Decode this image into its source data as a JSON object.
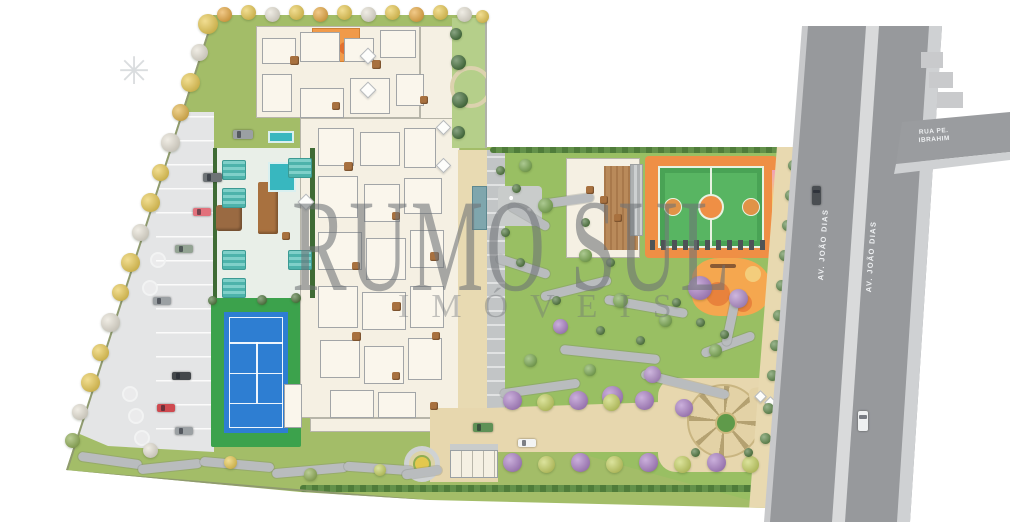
{
  "watermark": {
    "line1": "RUMO SUL",
    "line2": "IMÓVEIS",
    "color": "#6e7276"
  },
  "streets": {
    "avenue_left_label": "AV. JOÃO DIAS",
    "avenue_right_label": "AV. JOÃO DIAS",
    "side_street_label": "RUA PE. IBRAHIM"
  },
  "colors": {
    "lawn": "#a3bd68",
    "garden": "#99bf63",
    "asphalt": "#97999c",
    "median": "#d9dadb",
    "sidewalk": "#cfd1d3",
    "parking": "#e4e5e6",
    "building": "#f5f0e3",
    "tennis_blue": "#2e7ed2",
    "tennis_green": "#3ca24c",
    "court_orange": "#ef8f45",
    "court_green": "#58b562",
    "play_orange": "#f5a74f",
    "pool_teal": "#38b7bf",
    "drive_beige": "#e7d7ae",
    "purple_tree": "#ab7fc6",
    "yellow_tree": "#e9c94f"
  },
  "scene": {
    "trees": [
      [
        208,
        24,
        20,
        "#e9c94f"
      ],
      [
        199,
        52,
        17,
        "#e6e1d4"
      ],
      [
        190,
        82,
        19,
        "#e9c94f"
      ],
      [
        180,
        112,
        17,
        "#e3b448"
      ],
      [
        170,
        142,
        19,
        "#e6e1d4"
      ],
      [
        160,
        172,
        17,
        "#e9c94f"
      ],
      [
        150,
        202,
        19,
        "#e9c94f"
      ],
      [
        140,
        232,
        17,
        "#e6e1d4"
      ],
      [
        130,
        262,
        19,
        "#e9c94f"
      ],
      [
        120,
        292,
        17,
        "#e9c94f"
      ],
      [
        110,
        322,
        19,
        "#e6e1d4"
      ],
      [
        100,
        352,
        17,
        "#e9c94f"
      ],
      [
        90,
        382,
        19,
        "#e9c94f"
      ],
      [
        80,
        412,
        16,
        "#e6e1d4"
      ],
      [
        72,
        440,
        15,
        "#8fae53"
      ],
      [
        224,
        14,
        15,
        "#e8a83f"
      ],
      [
        248,
        12,
        15,
        "#e9c94f"
      ],
      [
        272,
        14,
        15,
        "#e6e1d4"
      ],
      [
        296,
        12,
        15,
        "#e9c94f"
      ],
      [
        320,
        14,
        15,
        "#e8a83f"
      ],
      [
        344,
        12,
        15,
        "#e9c94f"
      ],
      [
        368,
        14,
        15,
        "#e6e1d4"
      ],
      [
        392,
        12,
        15,
        "#e9c94f"
      ],
      [
        416,
        14,
        15,
        "#e8a83f"
      ],
      [
        440,
        12,
        15,
        "#e9c94f"
      ],
      [
        464,
        14,
        15,
        "#e6e1d4"
      ],
      [
        482,
        16,
        13,
        "#e9c94f"
      ],
      [
        700,
        288,
        24,
        "#ab7fc6"
      ],
      [
        738,
        298,
        19,
        "#b08ac9"
      ],
      [
        612,
        396,
        21,
        "#ab7fc6"
      ],
      [
        652,
        374,
        17,
        "#b08ac9"
      ],
      [
        560,
        326,
        15,
        "#ab7fc6"
      ],
      [
        684,
        408,
        18,
        "#ab7fc6"
      ],
      [
        525,
        165,
        13,
        "#79a84e"
      ],
      [
        545,
        205,
        15,
        "#79a84e"
      ],
      [
        585,
        255,
        13,
        "#79a84e"
      ],
      [
        620,
        300,
        15,
        "#79a84e"
      ],
      [
        665,
        320,
        13,
        "#79a84e"
      ],
      [
        715,
        350,
        13,
        "#79a84e"
      ],
      [
        590,
        370,
        12,
        "#79a84e"
      ],
      [
        530,
        360,
        13,
        "#79a84e"
      ],
      [
        512,
        400,
        19,
        "#ab7fc6"
      ],
      [
        545,
        402,
        17,
        "#c6d260"
      ],
      [
        578,
        400,
        19,
        "#ab7fc6"
      ],
      [
        611,
        402,
        17,
        "#c6d260"
      ],
      [
        644,
        400,
        19,
        "#ab7fc6"
      ],
      [
        788,
        390,
        15,
        "#ab7fc6"
      ],
      [
        512,
        462,
        19,
        "#ab7fc6"
      ],
      [
        546,
        464,
        17,
        "#c6d260"
      ],
      [
        580,
        462,
        19,
        "#ab7fc6"
      ],
      [
        614,
        464,
        17,
        "#c6d260"
      ],
      [
        648,
        462,
        19,
        "#ab7fc6"
      ],
      [
        682,
        464,
        17,
        "#c6d260"
      ],
      [
        716,
        462,
        19,
        "#ab7fc6"
      ],
      [
        750,
        464,
        17,
        "#c6d260"
      ],
      [
        782,
        458,
        16,
        "#ab7fc6"
      ],
      [
        793,
        165,
        11,
        "#5c8747"
      ],
      [
        790,
        195,
        11,
        "#5c8747"
      ],
      [
        787,
        225,
        11,
        "#5c8747"
      ],
      [
        784,
        255,
        11,
        "#5c8747"
      ],
      [
        781,
        285,
        11,
        "#5c8747"
      ],
      [
        778,
        315,
        11,
        "#5c8747"
      ],
      [
        775,
        345,
        11,
        "#5c8747"
      ],
      [
        772,
        375,
        11,
        "#5c8747"
      ],
      [
        768,
        408,
        11,
        "#5c8747"
      ],
      [
        765,
        438,
        11,
        "#5c8747"
      ],
      [
        150,
        450,
        15,
        "#e6e1d4"
      ],
      [
        230,
        462,
        13,
        "#e9c94f"
      ],
      [
        310,
        474,
        13,
        "#8fae53"
      ],
      [
        380,
        470,
        12,
        "#c6d260"
      ],
      [
        500,
        170,
        9,
        "#4a7338"
      ],
      [
        516,
        188,
        9,
        "#4a7338"
      ],
      [
        505,
        232,
        9,
        "#4a7338"
      ],
      [
        520,
        262,
        9,
        "#4a7338"
      ],
      [
        556,
        300,
        9,
        "#4a7338"
      ],
      [
        600,
        330,
        9,
        "#4a7338"
      ],
      [
        640,
        340,
        9,
        "#4a7338"
      ],
      [
        676,
        302,
        9,
        "#4a7338"
      ],
      [
        700,
        322,
        9,
        "#4a7338"
      ],
      [
        724,
        334,
        9,
        "#4a7338"
      ],
      [
        610,
        262,
        9,
        "#4a7338"
      ],
      [
        585,
        222,
        9,
        "#4a7338"
      ],
      [
        695,
        452,
        9,
        "#4a7338"
      ],
      [
        748,
        452,
        9,
        "#4a7338"
      ],
      [
        456,
        34,
        12,
        "#3f6b35"
      ],
      [
        458,
        62,
        15,
        "#3f6b35"
      ],
      [
        460,
        100,
        16,
        "#3f6b35"
      ],
      [
        458,
        132,
        13,
        "#3f6b35"
      ],
      [
        262,
        300,
        10,
        "#4a7338"
      ],
      [
        296,
        298,
        10,
        "#4a7338"
      ],
      [
        212,
        300,
        9,
        "#4a7338"
      ]
    ],
    "cars": [
      [
        233,
        130,
        20,
        9,
        "#9ba0a3"
      ],
      [
        203,
        173,
        19,
        9,
        "#6e7376"
      ],
      [
        193,
        208,
        18,
        8,
        "#e2717c"
      ],
      [
        175,
        245,
        18,
        8,
        "#93a393"
      ],
      [
        153,
        297,
        18,
        8,
        "#9ba0a3"
      ],
      [
        172,
        372,
        19,
        8,
        "#43474a"
      ],
      [
        157,
        404,
        18,
        8,
        "#cf4a50"
      ],
      [
        175,
        427,
        18,
        8,
        "#9ba0a3"
      ],
      [
        473,
        423,
        20,
        9,
        "#5f9156"
      ],
      [
        518,
        439,
        18,
        8,
        "#f3f4f4"
      ]
    ],
    "road_cars": [
      [
        812,
        186,
        9,
        19,
        "#4a4e52"
      ],
      [
        858,
        411,
        10,
        20,
        "#eef0f1"
      ]
    ],
    "rooms": [
      [
        262,
        38,
        34,
        26
      ],
      [
        300,
        32,
        40,
        30
      ],
      [
        344,
        38,
        30,
        24
      ],
      [
        380,
        30,
        36,
        28
      ],
      [
        262,
        74,
        30,
        38
      ],
      [
        300,
        88,
        44,
        30
      ],
      [
        350,
        78,
        40,
        36
      ],
      [
        396,
        74,
        28,
        32
      ],
      [
        318,
        128,
        36,
        38
      ],
      [
        360,
        132,
        40,
        34
      ],
      [
        404,
        128,
        32,
        40
      ],
      [
        318,
        176,
        40,
        42
      ],
      [
        364,
        184,
        36,
        38
      ],
      [
        404,
        178,
        38,
        36
      ],
      [
        318,
        232,
        44,
        38
      ],
      [
        366,
        238,
        40,
        42
      ],
      [
        410,
        230,
        34,
        38
      ],
      [
        318,
        286,
        40,
        42
      ],
      [
        362,
        292,
        44,
        38
      ],
      [
        410,
        286,
        34,
        42
      ],
      [
        320,
        340,
        40,
        38
      ],
      [
        364,
        346,
        40,
        38
      ],
      [
        408,
        338,
        34,
        42
      ],
      [
        330,
        390,
        44,
        28
      ],
      [
        378,
        392,
        38,
        26
      ],
      [
        284,
        384,
        18,
        44
      ]
    ],
    "furniture": [
      [
        290,
        56,
        9
      ],
      [
        332,
        102,
        8
      ],
      [
        372,
        60,
        9
      ],
      [
        420,
        96,
        8
      ],
      [
        344,
        162,
        9
      ],
      [
        392,
        212,
        8
      ],
      [
        430,
        252,
        9
      ],
      [
        352,
        262,
        8
      ],
      [
        392,
        302,
        9
      ],
      [
        432,
        332,
        8
      ],
      [
        352,
        332,
        9
      ],
      [
        392,
        372,
        8
      ],
      [
        430,
        402,
        8
      ],
      [
        282,
        232,
        8
      ],
      [
        600,
        196,
        8
      ],
      [
        614,
        214,
        8
      ],
      [
        586,
        186,
        8
      ]
    ],
    "paths": [
      [
        78,
        456,
        64,
        9,
        8
      ],
      [
        138,
        462,
        64,
        9,
        -6
      ],
      [
        200,
        460,
        74,
        9,
        5
      ],
      [
        272,
        466,
        76,
        9,
        -5
      ],
      [
        344,
        464,
        70,
        9,
        4
      ],
      [
        402,
        468,
        40,
        9,
        -8
      ],
      [
        495,
        262,
        56,
        9,
        18
      ],
      [
        540,
        284,
        72,
        9,
        -14
      ],
      [
        604,
        302,
        84,
        9,
        10
      ],
      [
        560,
        350,
        100,
        9,
        6
      ],
      [
        500,
        384,
        80,
        9,
        -8
      ],
      [
        640,
        380,
        90,
        9,
        14
      ],
      [
        700,
        340,
        56,
        9,
        -20
      ],
      [
        506,
        212,
        46,
        9,
        30
      ],
      [
        544,
        196,
        50,
        9,
        -8
      ],
      [
        726,
        300,
        9,
        46,
        12
      ]
    ],
    "loungers": [
      [
        222,
        160
      ],
      [
        222,
        188
      ],
      [
        222,
        250
      ],
      [
        222,
        278
      ],
      [
        288,
        158
      ],
      [
        288,
        250
      ]
    ],
    "planters": [
      [
        122,
        386,
        16
      ],
      [
        128,
        408,
        16
      ],
      [
        134,
        430,
        16
      ],
      [
        150,
        252,
        16
      ],
      [
        142,
        280,
        16
      ]
    ],
    "canopies": [
      [
        362,
        50,
        12
      ],
      [
        362,
        84,
        12
      ],
      [
        300,
        196,
        12
      ],
      [
        438,
        122,
        11
      ],
      [
        438,
        160,
        11
      ],
      [
        756,
        392,
        9
      ],
      [
        766,
        398,
        9
      ],
      [
        776,
        404,
        9
      ]
    ]
  }
}
